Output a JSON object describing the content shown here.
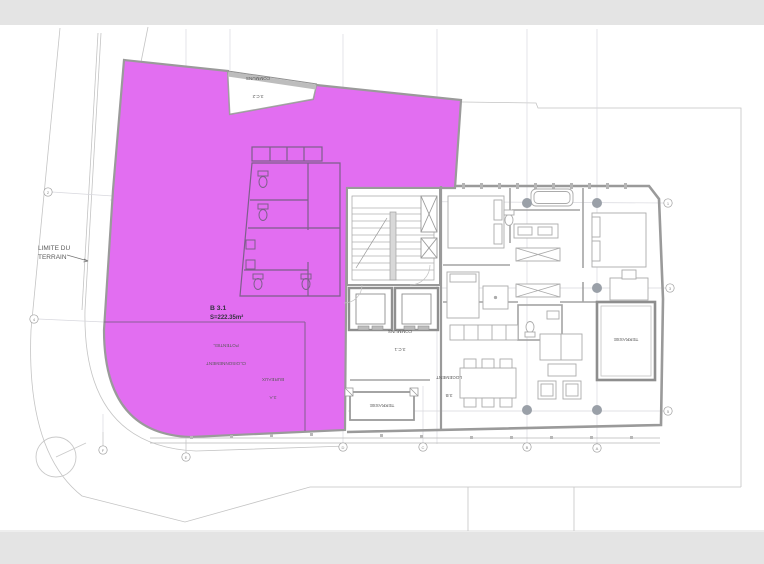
{
  "plan": {
    "title": "floor-plan-level-3",
    "terrain": {
      "line1": "LIMITE DU",
      "line2": "TERRAIN"
    },
    "unit": {
      "code": "B 3.1",
      "area": "S=222.35m²"
    },
    "rooms": {
      "communs_top": {
        "code": "3.C.2",
        "name": "COMMUNS"
      },
      "communs_mid": {
        "code": "3.C.1",
        "name": "COMMUNS"
      },
      "bureaux": {
        "code": "3.A",
        "name": "BUREAUX"
      },
      "cloisonnement": {
        "line1": "CLOISONNEMENT",
        "line2": "POTENTIEL"
      },
      "logement": {
        "code": "3.B",
        "name": "LOGEMENT"
      },
      "terrasse_center": "TERRASSE",
      "terrasse_right": "TERRASSE"
    },
    "grid": {
      "bottom": [
        "F",
        "E",
        "D",
        "C",
        "B",
        "A"
      ],
      "left": [
        "2",
        "4"
      ],
      "right": [
        "1",
        "3",
        "5"
      ]
    },
    "colors": {
      "unit_fill": "#e26ef1",
      "unit_stroke": "#b85ec9",
      "wall": "#9a9a9a",
      "band": "#e4e4e4"
    }
  }
}
